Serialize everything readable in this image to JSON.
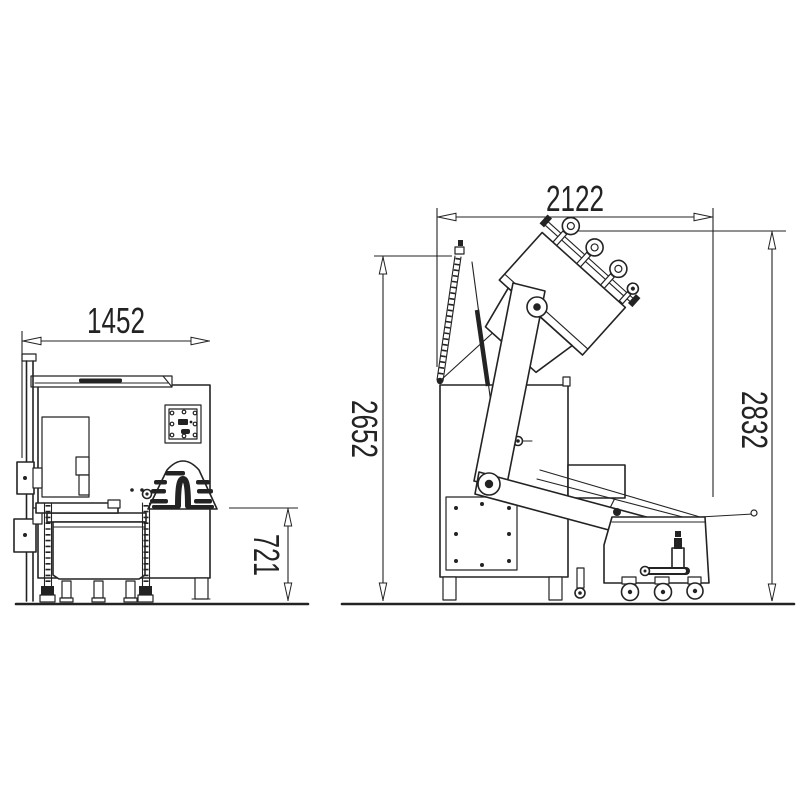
{
  "drawing": {
    "background_color": "#ffffff",
    "line_color": "#232323",
    "front_view": {
      "width_mm": "1452",
      "loading_height_mm": "721"
    },
    "side_view": {
      "depth_mm": "2122",
      "column_height_mm": "2652",
      "tipping_height_mm": "2832"
    }
  }
}
